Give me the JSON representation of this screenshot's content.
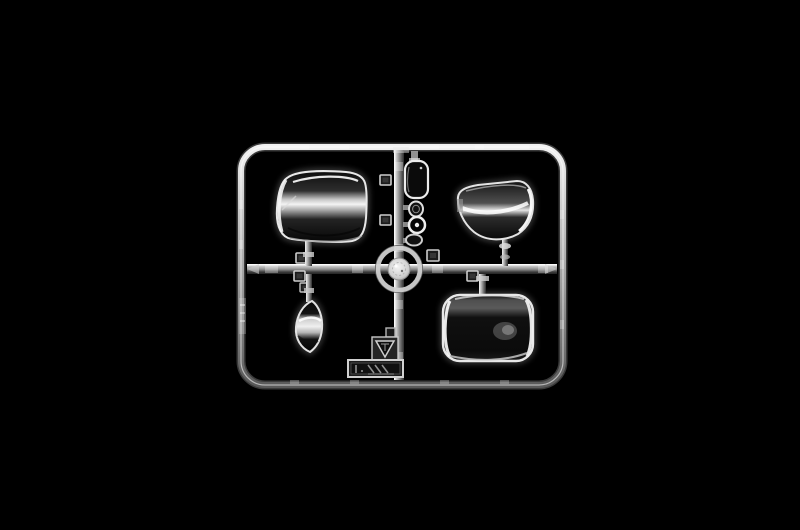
{
  "scene": {
    "kind": "photograph",
    "subject": "Clear transparent plastic model-kit sprue with windscreen and lens parts on a black background",
    "background_color": "#000000",
    "plastic_edge_color": "#d6d6d6",
    "plastic_dark_color": "#1a1a1a"
  },
  "sprue": {
    "frame_label": "rectangular sprue frame with rounded corners",
    "runner_horizontal_label": "horizontal runner bar",
    "runner_vertical_label": "vertical runner bar",
    "hub_label": "central circular injection hub",
    "gate_tab_label": "small square gate tab",
    "gate_tab_count": 7,
    "parts": [
      {
        "id": "windscreen-upper-left",
        "label": "large curved wrap-around windscreen part, upper left quadrant"
      },
      {
        "id": "window-pane-top-center",
        "label": "small rounded rectangular window pane part, top center"
      },
      {
        "id": "lens-oval-upper",
        "label": "small oval lamp lens part"
      },
      {
        "id": "lens-ring",
        "label": "small round ring lens part with center boss"
      },
      {
        "id": "lens-oval-lower",
        "label": "small oval lamp lens part"
      },
      {
        "id": "windscreen-upper-right",
        "label": "curved dome windscreen part, upper right quadrant"
      },
      {
        "id": "window-crescent",
        "label": "crescent shaped curved side window part, lower left quadrant"
      },
      {
        "id": "windscreen-lower-right",
        "label": "large wrap-around windscreen part, lower right quadrant"
      }
    ],
    "markings": [
      {
        "id": "material-triangle",
        "label": "molded inverted-triangle material mark on square plate"
      },
      {
        "id": "mold-stamp",
        "label": "embossed rectangular mold stamp plate, lettering illegible"
      },
      {
        "id": "frame-embossing",
        "label": "faint embossed marking on left frame bar"
      }
    ]
  }
}
